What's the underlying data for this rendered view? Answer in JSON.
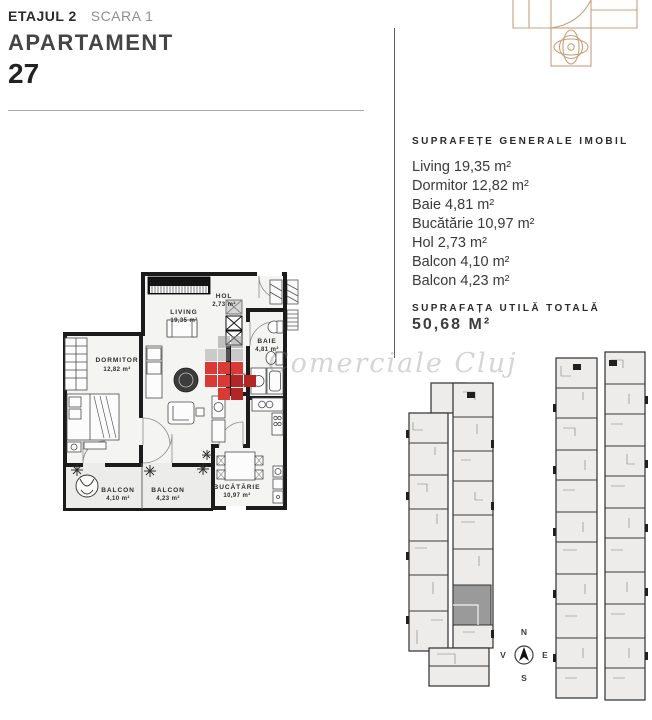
{
  "header": {
    "floor": "ETAJUL 2",
    "stair": "SCARA 1",
    "label": "APARTAMENT",
    "number": "27"
  },
  "surfaces": {
    "title": "SUPRAFEȚE GENERALE IMOBIL",
    "items": [
      {
        "label": "Living",
        "value": "19,35 m²"
      },
      {
        "label": "Dormitor",
        "value": "12,82 m²"
      },
      {
        "label": "Baie",
        "value": "4,81 m²"
      },
      {
        "label": "Bucătărie",
        "value": "10,97 m²"
      },
      {
        "label": "Hol",
        "value": "2,73 m²"
      },
      {
        "label": "Balcon",
        "value": "4,10 m²"
      },
      {
        "label": "Balcon",
        "value": "4,23 m²"
      }
    ]
  },
  "total": {
    "title": "SUPRAFAȚA UTILĂ TOTALĂ",
    "value": "50,68 M²"
  },
  "floor_plan": {
    "rooms": [
      {
        "name": "LIVING",
        "area": "19,35 m²"
      },
      {
        "name": "HOL",
        "area": "2,73 m²"
      },
      {
        "name": "BAIE",
        "area": "4,81 m²"
      },
      {
        "name": "DORMITOR",
        "area": "12,82 m²"
      },
      {
        "name": "BALCON",
        "area": "4,10 m²"
      },
      {
        "name": "BALCON",
        "area": "4,23 m²"
      },
      {
        "name": "BUCĂTĂRIE",
        "area": "10,97 m²"
      }
    ]
  },
  "compass": {
    "north": "N",
    "south": "S",
    "east": "E",
    "west": "V"
  },
  "watermark": {
    "text": "Comerciale Cluj"
  },
  "colors": {
    "accent_tan": "#c8a07d",
    "wall_black": "#1b1b1b",
    "watermark_red": "#d93a35",
    "watermark_dark_red": "#b22724",
    "unit_highlight": "#9a9a9a"
  }
}
